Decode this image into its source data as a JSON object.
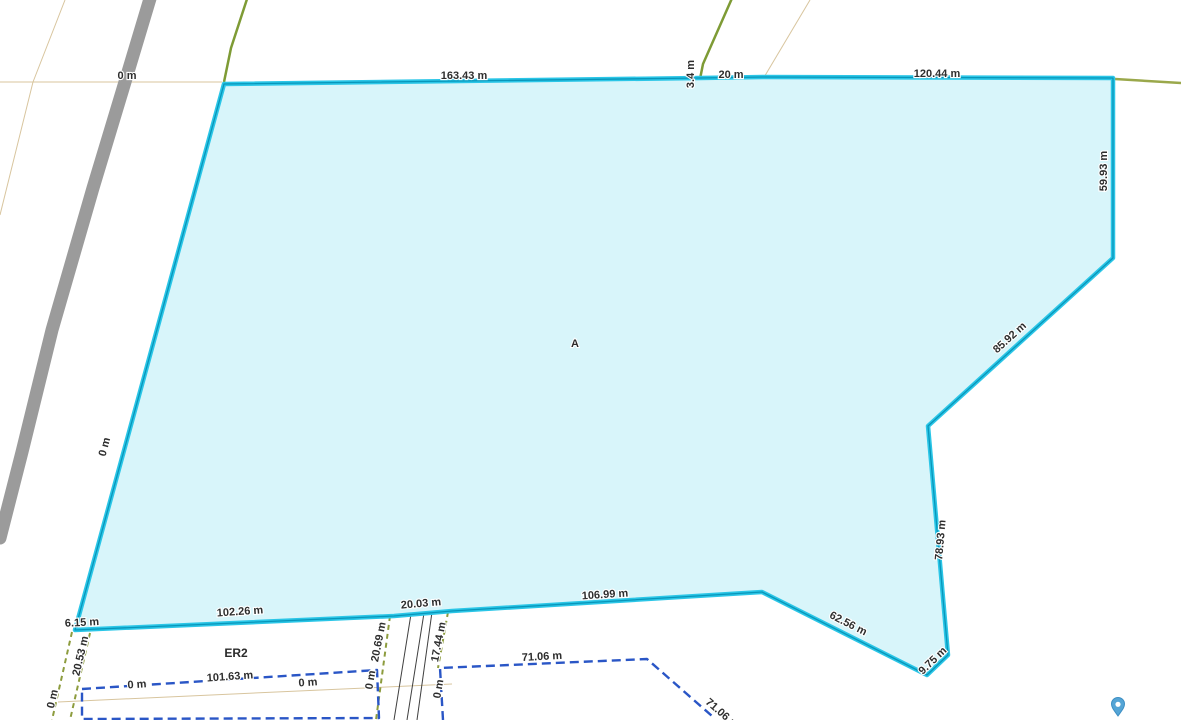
{
  "map": {
    "background": "#ffffff",
    "area_label": {
      "text": "A",
      "x": 575,
      "y": 344
    },
    "zone_label": {
      "text": "ER2",
      "x": 236,
      "y": 654
    },
    "colors": {
      "parcel_fill": "#d8f5fa",
      "parcel_stroke_outer": "#2bc6e7",
      "parcel_stroke_core": "#0896ba",
      "road_gray": "#9b9b9b",
      "cadastral_green": "#7e9b35",
      "cadastral_olive": "#9aa84b",
      "corridor_olive_dashed": "#8d9c3e",
      "parcel_blue_dashed": "#2a56c6",
      "grid_tan": "#d8c59e",
      "track_black": "#3f3f3f",
      "label_text": "#2e2e2e",
      "pin_blue": "#55a5d6"
    },
    "parcel_a": {
      "vertices": [
        [
          224,
          84
        ],
        [
          700,
          78
        ],
        [
          763,
          77
        ],
        [
          1113,
          78
        ],
        [
          1113,
          258
        ],
        [
          928,
          426
        ],
        [
          948,
          655
        ],
        [
          927,
          675
        ],
        [
          762,
          592
        ],
        [
          452,
          611
        ],
        [
          394,
          616
        ],
        [
          75,
          630
        ]
      ]
    },
    "lines": [
      {
        "name": "grid-line-tan-horizontal",
        "color": "#d8c59e",
        "w": 1,
        "pts": [
          [
            0,
            82
          ],
          [
            222,
            82
          ]
        ]
      },
      {
        "name": "grid-line-tan-diagonal-left",
        "color": "#d8c59e",
        "w": 1,
        "pts": [
          [
            65,
            0
          ],
          [
            33,
            82
          ],
          [
            0,
            215
          ]
        ]
      },
      {
        "name": "grid-line-tan-diagonal-right",
        "color": "#d8c59e",
        "w": 1,
        "pts": [
          [
            810,
            0
          ],
          [
            763,
            79
          ]
        ]
      },
      {
        "name": "grid-line-tan-bottom",
        "color": "#d8c59e",
        "w": 1,
        "pts": [
          [
            58,
            702
          ],
          [
            452,
            684
          ]
        ]
      },
      {
        "name": "road-line-gray",
        "color": "#9b9b9b",
        "w": 13,
        "pts": [
          [
            152,
            -8
          ],
          [
            128,
            72
          ],
          [
            93,
            188
          ],
          [
            52,
            330
          ],
          [
            22,
            452
          ],
          [
            0,
            538
          ]
        ]
      },
      {
        "name": "cadastral-line-green-topleft",
        "color": "#7e9b35",
        "w": 2.5,
        "pts": [
          [
            248,
            -4
          ],
          [
            231,
            48
          ],
          [
            224,
            82
          ]
        ]
      },
      {
        "name": "cadastral-line-green-topmid",
        "color": "#7e9b35",
        "w": 2.5,
        "pts": [
          [
            733,
            -4
          ],
          [
            703,
            64
          ],
          [
            700,
            79
          ]
        ]
      },
      {
        "name": "cadastral-line-olive-topright",
        "color": "#9aa84b",
        "w": 2.5,
        "pts": [
          [
            1115,
            79
          ],
          [
            1181,
            83
          ]
        ]
      },
      {
        "name": "track-line-1",
        "color": "#3f3f3f",
        "w": 1,
        "pts": [
          [
            411,
            614
          ],
          [
            394,
            720
          ]
        ]
      },
      {
        "name": "track-line-2",
        "color": "#3f3f3f",
        "w": 1,
        "pts": [
          [
            424,
            613
          ],
          [
            407,
            720
          ]
        ]
      },
      {
        "name": "track-line-3",
        "color": "#3f3f3f",
        "w": 1,
        "pts": [
          [
            432,
            612
          ],
          [
            417,
            720
          ]
        ]
      },
      {
        "name": "corridor-dashed-left-a",
        "color": "#8d9c3e",
        "w": 2,
        "dash": "5,4",
        "pts": [
          [
            72,
            632
          ],
          [
            52,
            720
          ]
        ]
      },
      {
        "name": "corridor-dashed-left-b",
        "color": "#8d9c3e",
        "w": 2,
        "dash": "5,4",
        "pts": [
          [
            90,
            633
          ],
          [
            70,
            720
          ]
        ]
      },
      {
        "name": "corridor-dashed-road-west",
        "color": "#8d9c3e",
        "w": 2,
        "dash": "5,4",
        "pts": [
          [
            390,
            616
          ],
          [
            376,
            720
          ]
        ]
      },
      {
        "name": "corridor-dashed-road-east",
        "color": "#8d9c3e",
        "w": 2,
        "dash": "5,4",
        "pts": [
          [
            448,
            612
          ],
          [
            438,
            668
          ]
        ]
      },
      {
        "name": "parcel-boundary-blue-west",
        "color": "#2a56c6",
        "w": 2.4,
        "dash": "9,5",
        "pts": [
          [
            82,
            689
          ],
          [
            377,
            670
          ],
          [
            379,
            718
          ],
          [
            82,
            719
          ],
          [
            82,
            689
          ]
        ]
      },
      {
        "name": "parcel-boundary-blue-east",
        "color": "#2a56c6",
        "w": 2.4,
        "dash": "9,5",
        "pts": [
          [
            443,
            720
          ],
          [
            440,
            668
          ],
          [
            647,
            659
          ],
          [
            712,
            716
          ]
        ]
      }
    ],
    "measurement_labels": [
      {
        "text": "0 m",
        "x": 127,
        "y": 76,
        "r": 0
      },
      {
        "text": "163.43 m",
        "x": 464,
        "y": 76,
        "r": 0
      },
      {
        "text": "3.4 m",
        "x": 691,
        "y": 74,
        "r": -90
      },
      {
        "text": "20 m",
        "x": 731,
        "y": 75,
        "r": 0
      },
      {
        "text": "120.44 m",
        "x": 937,
        "y": 74,
        "r": 0
      },
      {
        "text": "59.93 m",
        "x": 1104,
        "y": 171,
        "r": -90
      },
      {
        "text": "85.92 m",
        "x": 1010,
        "y": 338,
        "r": -42
      },
      {
        "text": "78.93 m",
        "x": 941,
        "y": 540,
        "r": -85
      },
      {
        "text": "9.75 m",
        "x": 933,
        "y": 661,
        "r": -44
      },
      {
        "text": "62.56 m",
        "x": 848,
        "y": 624,
        "r": 27
      },
      {
        "text": "106.99 m",
        "x": 605,
        "y": 595,
        "r": -3.5
      },
      {
        "text": "20.03 m",
        "x": 421,
        "y": 604,
        "r": -5
      },
      {
        "text": "102.26 m",
        "x": 240,
        "y": 612,
        "r": -4
      },
      {
        "text": "6.15 m",
        "x": 82,
        "y": 623,
        "r": -3
      },
      {
        "text": "0 m",
        "x": 105,
        "y": 447,
        "r": -75
      },
      {
        "text": "20.53 m",
        "x": 81,
        "y": 656,
        "r": -77
      },
      {
        "text": "0 m",
        "x": 53,
        "y": 699,
        "r": -77
      },
      {
        "text": "20.69 m",
        "x": 379,
        "y": 642,
        "r": -79
      },
      {
        "text": "17.44 m",
        "x": 439,
        "y": 642,
        "r": -79
      },
      {
        "text": "101.63 m",
        "x": 230,
        "y": 677,
        "r": -4
      },
      {
        "text": "0 m",
        "x": 137,
        "y": 685,
        "r": -4
      },
      {
        "text": "0 m",
        "x": 308,
        "y": 683,
        "r": -4
      },
      {
        "text": "0 m",
        "x": 371,
        "y": 680,
        "r": -80
      },
      {
        "text": "0 m",
        "x": 439,
        "y": 689,
        "r": -80
      },
      {
        "text": "71.06 m",
        "x": 542,
        "y": 657,
        "r": -3
      },
      {
        "text": "71.06 m",
        "x": 722,
        "y": 714,
        "r": 41
      }
    ],
    "pin_marker": {
      "x": 1118,
      "y": 716
    }
  }
}
